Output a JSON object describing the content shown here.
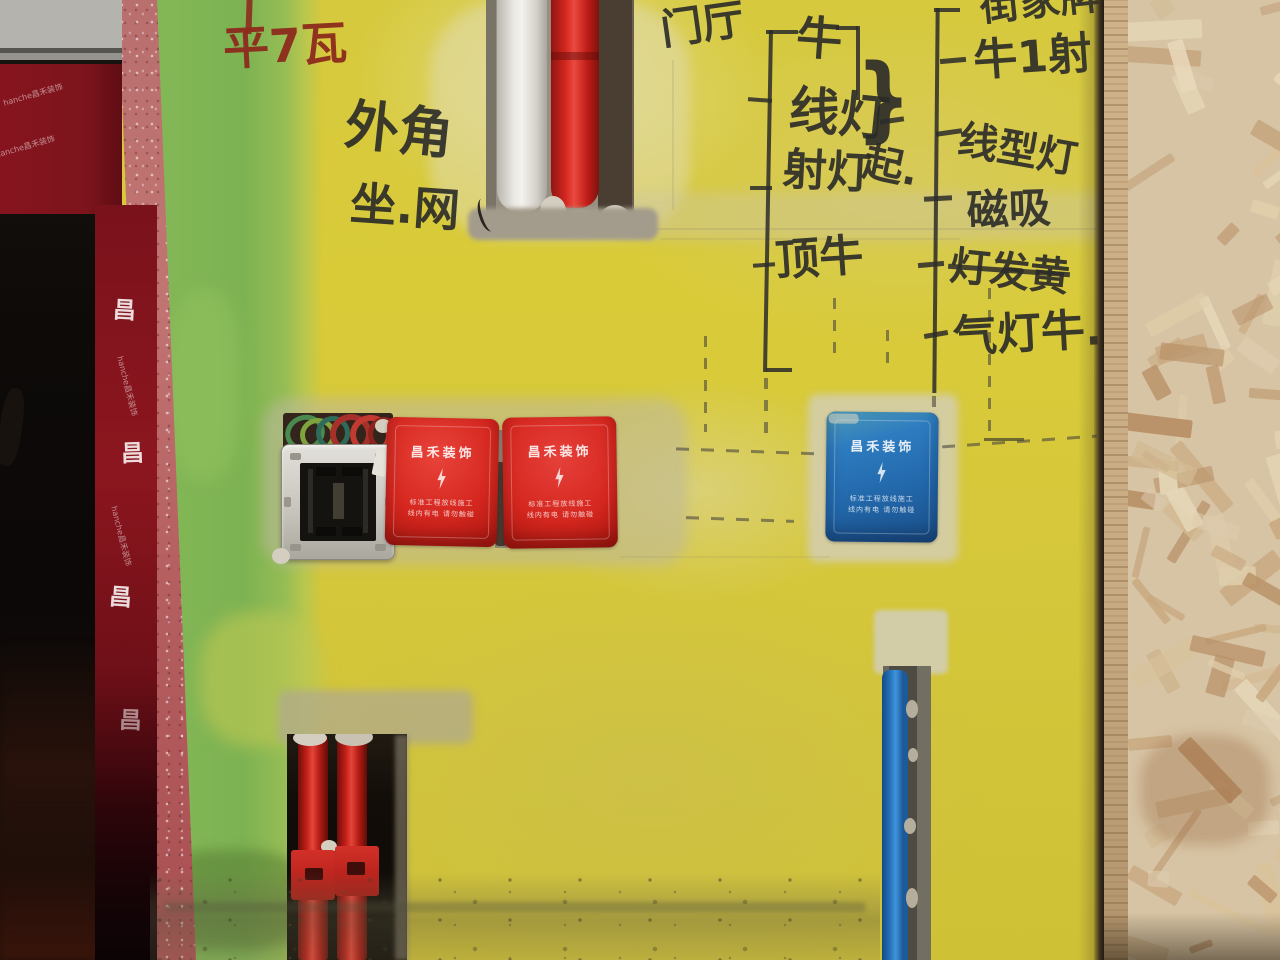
{
  "scene": {
    "description": "Construction-site wall painted yellow and green with handwritten electrical layout notes, embedded conduit pipes, junction boxes with branded covers, red protective sheeting by a dark doorway, and an OSB board leaning at right"
  },
  "door_area": {
    "sheet_brand_text": "hanche昌禾装饰",
    "sheet_logo_char": "昌"
  },
  "wall_text": {
    "red_note": "平7瓦",
    "corner_note_line1": "外角",
    "corner_note_line2": "坐.网",
    "door_list": {
      "title": "门厅",
      "items": [
        {
          "label": "牛"
        },
        {
          "label": "线灯"
        },
        {
          "label": "射灯"
        },
        {
          "label": "顶牛"
        }
      ],
      "brace_char": "}",
      "brace_note": "起."
    },
    "right_list": {
      "items": [
        {
          "label": "街家牌",
          "strikethrough": false
        },
        {
          "label": "牛1射",
          "strikethrough": false
        },
        {
          "label": "线型灯",
          "strikethrough": false
        },
        {
          "label": "磁吸",
          "strikethrough": false
        },
        {
          "label": "灯发黄",
          "strikethrough": true
        },
        {
          "label": "气灯牛.",
          "strikethrough": false
        }
      ]
    }
  },
  "junction_covers": {
    "brand": "昌禾装饰",
    "warning_line1": "标准工程放线施工",
    "warning_line2": "线内有电 请勿触碰",
    "red_color": "#d5271f",
    "blue_color": "#2470b3"
  },
  "pipes": {
    "top_chase": [
      "white",
      "red"
    ],
    "bottom_left_chase": [
      "red",
      "red"
    ],
    "bottom_right_chase": [
      "blue"
    ],
    "red_color": "#d6241d",
    "blue_color": "#2f86d4",
    "white_color": "#efece6"
  },
  "materials": {
    "wall_yellow": "#d8c832",
    "wall_green": "#7cb454",
    "corner_pink": "#b86f6d",
    "sheet_red": "#7d141c",
    "osb_tan": "#d7c4a4"
  }
}
